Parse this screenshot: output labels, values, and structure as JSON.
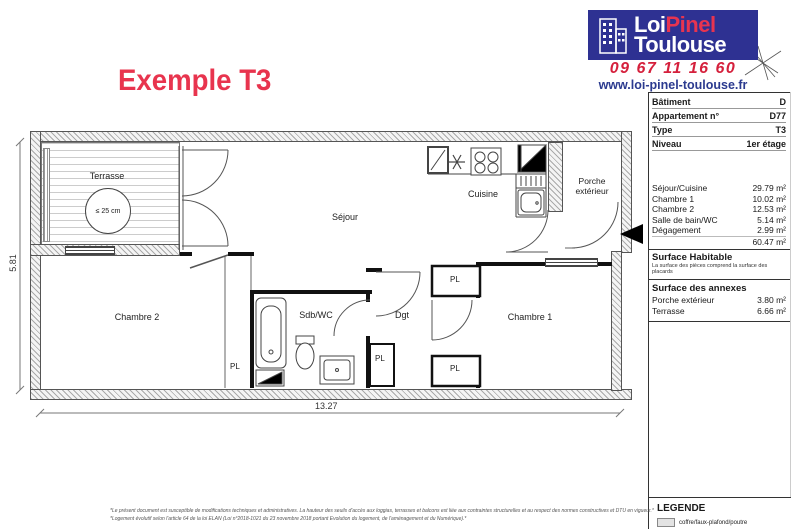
{
  "title": "Exemple T3",
  "logo": {
    "brand_word1": "Loi",
    "brand_word2": "Pinel",
    "brand_word3": "Toulouse",
    "phone": "09 67 11 16 60",
    "website": "www.loi-pinel-toulouse.fr"
  },
  "colors": {
    "brand_blue": "#2e3192",
    "brand_red": "#e73450",
    "phone_red": "#d5203c",
    "link_blue": "#2b3a8f",
    "title_red": "#e8344e"
  },
  "info": {
    "rows": [
      {
        "label": "Bâtiment",
        "value": "D"
      },
      {
        "label": "Appartement n°",
        "value": "D77"
      },
      {
        "label": "Type",
        "value": "T3"
      },
      {
        "label": "Niveau",
        "value": "1er étage"
      }
    ]
  },
  "surfaces": {
    "rows": [
      {
        "label": "Séjour/Cuisine",
        "value": "29.79 m²"
      },
      {
        "label": "Chambre 1",
        "value": "10.02 m²"
      },
      {
        "label": "Chambre 2",
        "value": "12.53 m²"
      },
      {
        "label": "Salle de bain/WC",
        "value": "5.14 m²"
      },
      {
        "label": "Dégagement",
        "value": "2.99 m²"
      }
    ],
    "total": "60.47 m²",
    "habitable_title": "Surface Habitable",
    "habitable_note": "La surface des pièces comprend la surface des placards"
  },
  "annexes": {
    "title": "Surface des annexes",
    "rows": [
      {
        "label": "Porche extérieur",
        "value": "3.80 m²"
      },
      {
        "label": "Terrasse",
        "value": "6.66 m²"
      }
    ]
  },
  "legend": {
    "title": "LEGENDE",
    "item1": "coffre/faux-plafond/poutre"
  },
  "plan": {
    "rooms": {
      "terrasse": "Terrasse",
      "sejour": "Séjour",
      "cuisine": "Cuisine",
      "porche_1": "Porche",
      "porche_2": "extérieur",
      "chambre2": "Chambre 2",
      "sdb": "Sdb/WC",
      "dgt": "Dgt",
      "chambre1": "Chambre 1"
    },
    "pl": "PL",
    "threshold": "≤ 25 cm",
    "dim_width": "13.27",
    "dim_height": "5.81"
  },
  "footnotes": {
    "line1": "*Le présent document est susceptible de modifications techniques et administratives. La hauteur des seuils d'accès aux loggias, terrasses et balcons est liée aux contraintes structurelles et au respect des normes constructives et DTU en vigueur.*",
    "line2": "*Logement évolutif selon l'article 64 de la loi ELAN (Loi n°2018-1021 du 23 novembre 2018 portant Evolution du logement, de l'aménagement et du Numérique).*"
  }
}
